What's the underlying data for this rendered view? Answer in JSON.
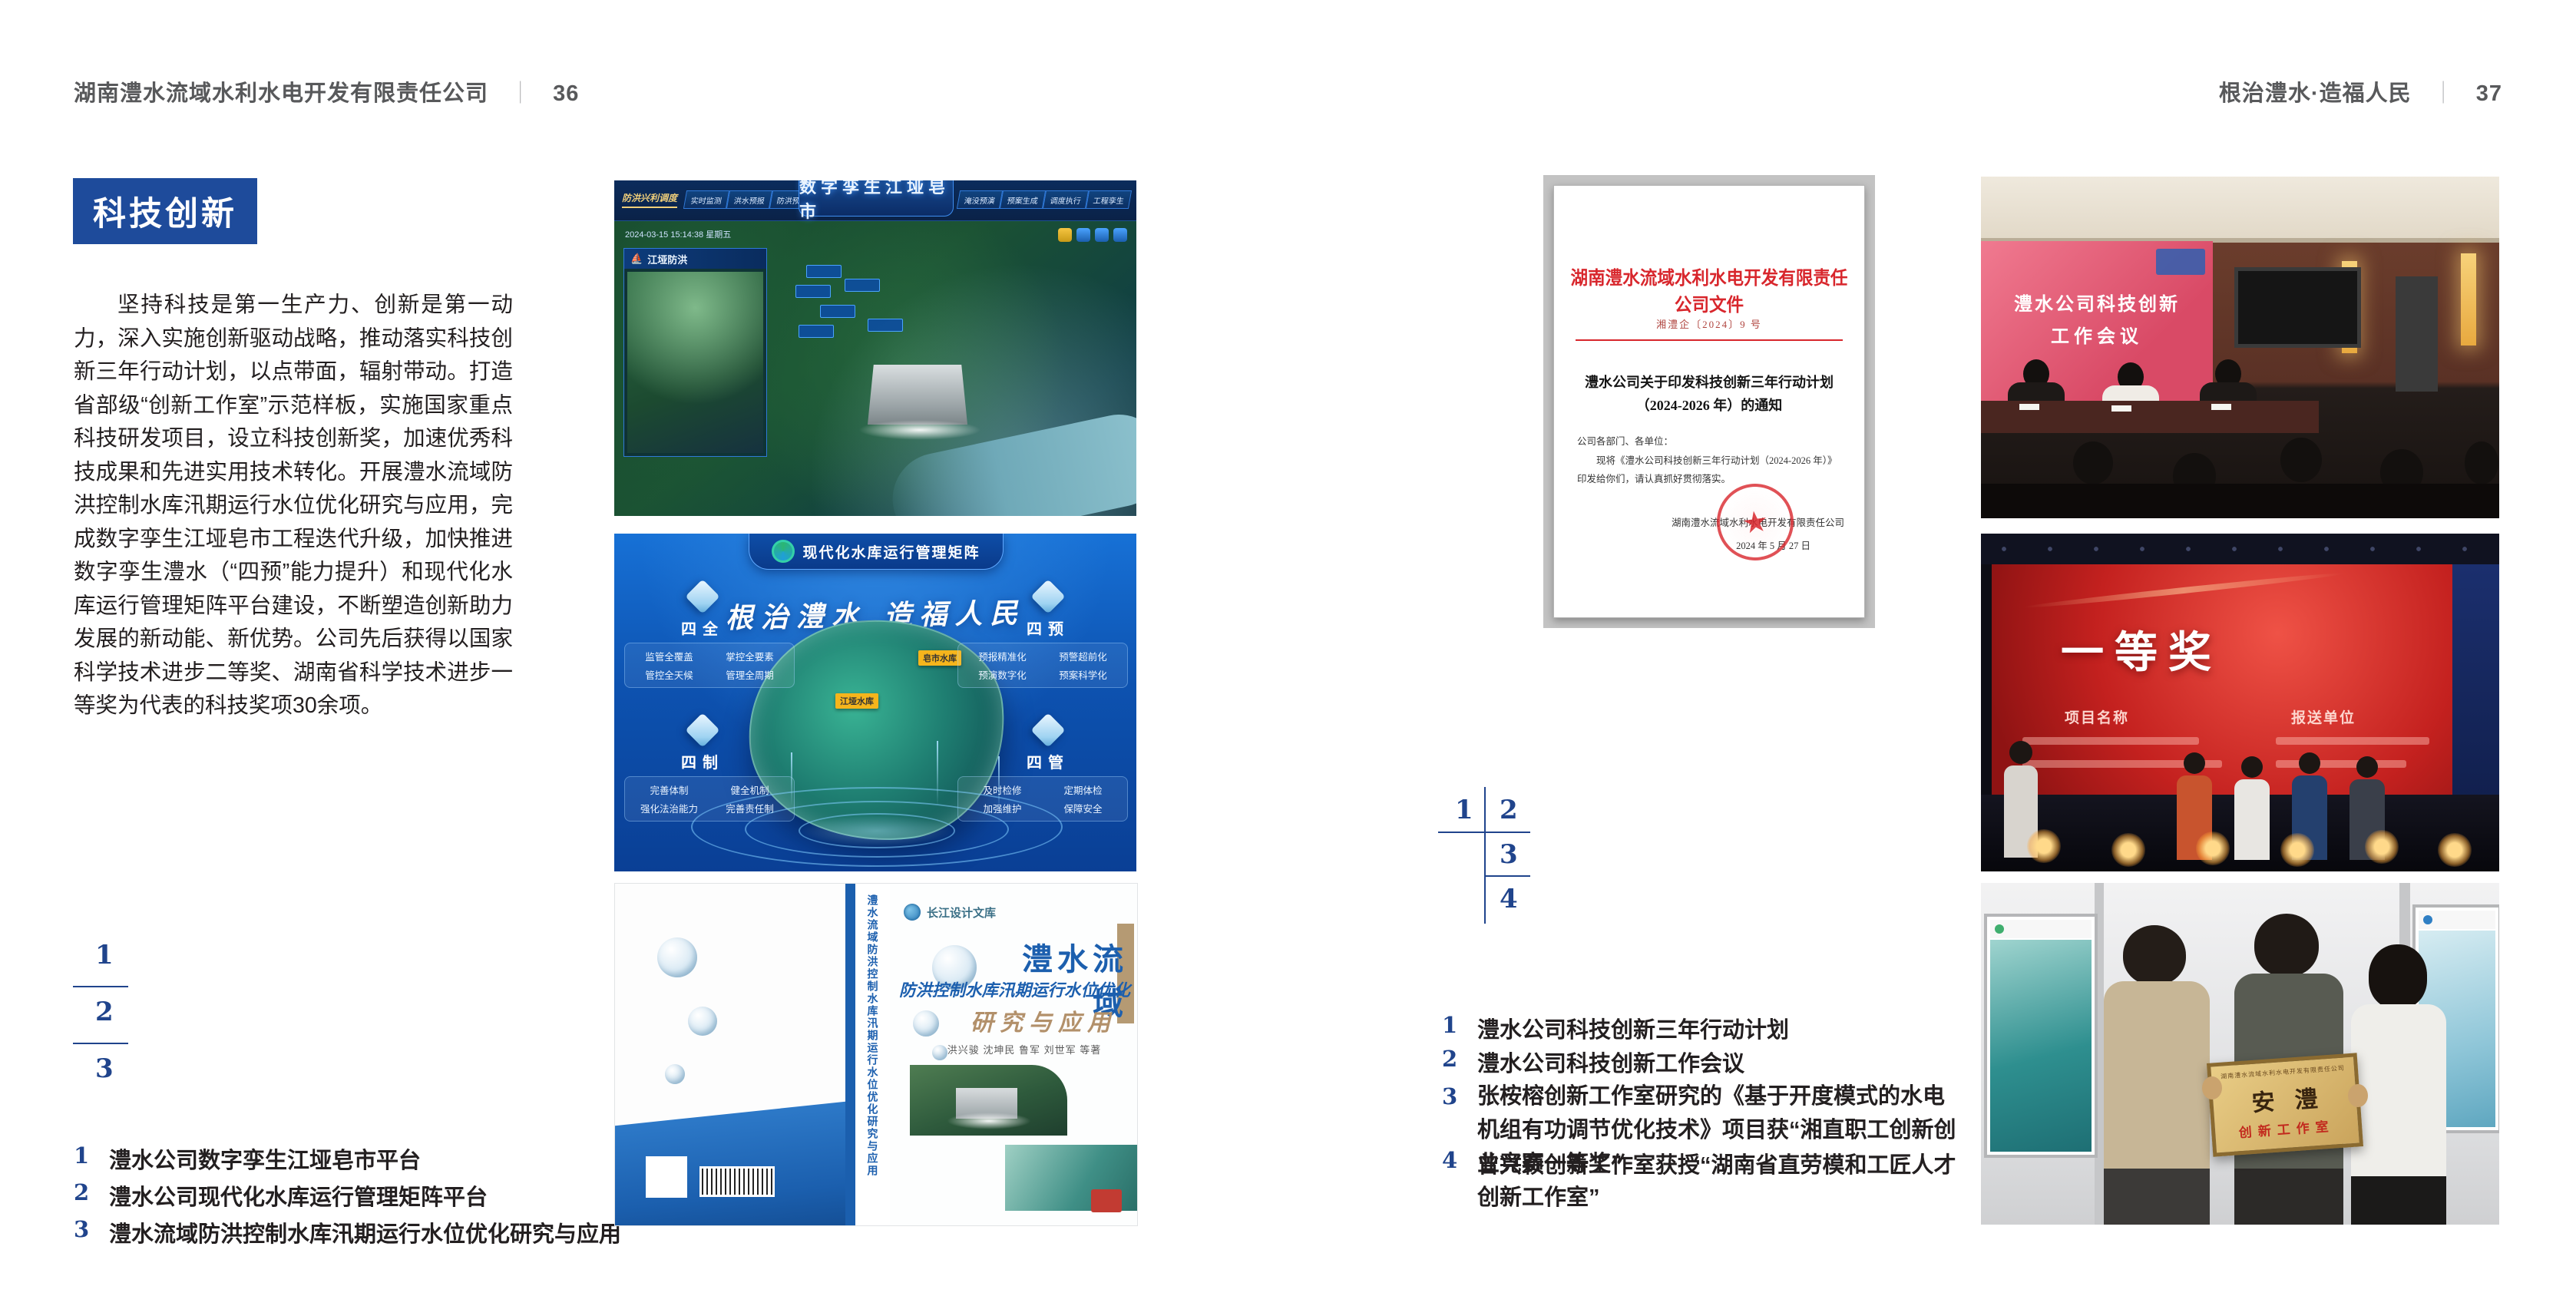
{
  "doc": {
    "header_left": {
      "title": "湖南澧水流域水利水电开发有限责任公司",
      "sep": "｜",
      "page": "36"
    },
    "header_right": {
      "title": "根治澧水·造福人民",
      "sep": "｜",
      "page": "37"
    }
  },
  "left_page": {
    "badge": "科技创新",
    "paragraph": "坚持科技是第一生产力、创新是第一动力，深入实施创新驱动战略，推动落实科技创新三年行动计划，以点带面，辐射带动。打造省部级“创新工作室”示范样板，实施国家重点科技研发项目，设立科技创新奖，加速优秀科技成果和先进实用技术转化。开展澧水流域防洪控制水库汛期运行水位优化研究与应用，完成数字孪生江垭皂市工程迭代升级，加快推进数字孪生澧水（“四预”能力提升）和现代化水库运行管理矩阵平台建设，不断塑造创新助力发展的新动能、新优势。公司先后获得以国家科学技术进步二等奖、湖南省科学技术进步一等奖为代表的科技奖项30余项。",
    "index": [
      "1",
      "2",
      "3"
    ],
    "captions": [
      {
        "n": "1",
        "t": "澧水公司数字孪生江垭皂市平台"
      },
      {
        "n": "2",
        "t": "澧水公司现代化水库运行管理矩阵平台"
      },
      {
        "n": "3",
        "t": "澧水流域防洪控制水库汛期运行水位优化研究与应用"
      }
    ]
  },
  "right_page": {
    "index": [
      "1",
      "2",
      "3",
      "4"
    ],
    "captions": [
      {
        "n": "1",
        "t": "澧水公司科技创新三年行动计划"
      },
      {
        "n": "2",
        "t": "澧水公司科技创新工作会议"
      },
      {
        "n": "3",
        "t": "张桉榕创新工作室研究的《基于开度模式的水电机组有功调节优化技术》项目获“湘直职工创新创业竞赛一等奖”"
      },
      {
        "n": "4",
        "t": "曾兴颖创新工作室获授“湖南省直劳模和工匠人才创新工作室”"
      }
    ]
  },
  "fig_dashboard": {
    "title": "数字孪生江垭皂市",
    "group_label": "防洪兴利调度",
    "tabs_left": [
      "实时监测",
      "洪水预报",
      "防洪预警"
    ],
    "tabs_right": [
      "淹没预演",
      "预案生成",
      "调度执行",
      "工程孪生"
    ],
    "timestamp": "2024-03-15 15:14:38 星期五",
    "panel_title": "江垭防洪"
  },
  "fig_matrix": {
    "title": "现代化水库运行管理矩阵",
    "slogan": "根治澧水 造福人民",
    "nodes": [
      {
        "name": "四全",
        "items": [
          "监管全覆盖",
          "掌控全要素",
          "管控全天候",
          "管理全周期"
        ]
      },
      {
        "name": "四预",
        "items": [
          "预报精准化",
          "预警超前化",
          "预演数字化",
          "预案科学化"
        ]
      },
      {
        "name": "四制",
        "items": [
          "完善体制",
          "健全机制",
          "强化法治能力",
          "完善责任制"
        ]
      },
      {
        "name": "四管",
        "items": [
          "及时检修",
          "定期体检",
          "加强维护",
          "保障安全"
        ]
      }
    ],
    "map_tags": [
      "江垭水库",
      "皂市水库"
    ]
  },
  "fig_book": {
    "series": "长江设计文库",
    "title1": "澧水流域",
    "title2": "防洪控制水库汛期运行水位优化",
    "title3": "研究与应用",
    "authors": "洪兴骏  沈坤民  鲁军  刘世军  等著",
    "spine": "澧水流域防洪控制水库汛期运行水位优化研究与应用"
  },
  "fig_document": {
    "header": "湖南澧水流域水利水电开发有限责任公司文件",
    "number": "湘澧企〔2024〕9 号",
    "title_line1": "澧水公司关于印发科技创新三年行动计划",
    "title_line2": "（2024-2026 年）的通知",
    "salutation": "公司各部门、各单位：",
    "body": "现将《澧水公司科技创新三年行动计划（2024-2026 年）》印发给你们，请认真抓好贯彻落实。",
    "signer": "湖南澧水流域水利水电开发有限责任公司",
    "date": "2024 年 5 月 27 日"
  },
  "fig_meeting": {
    "screen_line1": "澧水公司科技创新",
    "screen_line2": "工作会议"
  },
  "fig_award": {
    "title": "一等奖",
    "col1": "项目名称",
    "col2": "报送单位"
  },
  "fig_plaque": {
    "org": "湖南澧水流域水利水电开发有限责任公司",
    "name": "安澧",
    "sub": "创新工作室"
  }
}
